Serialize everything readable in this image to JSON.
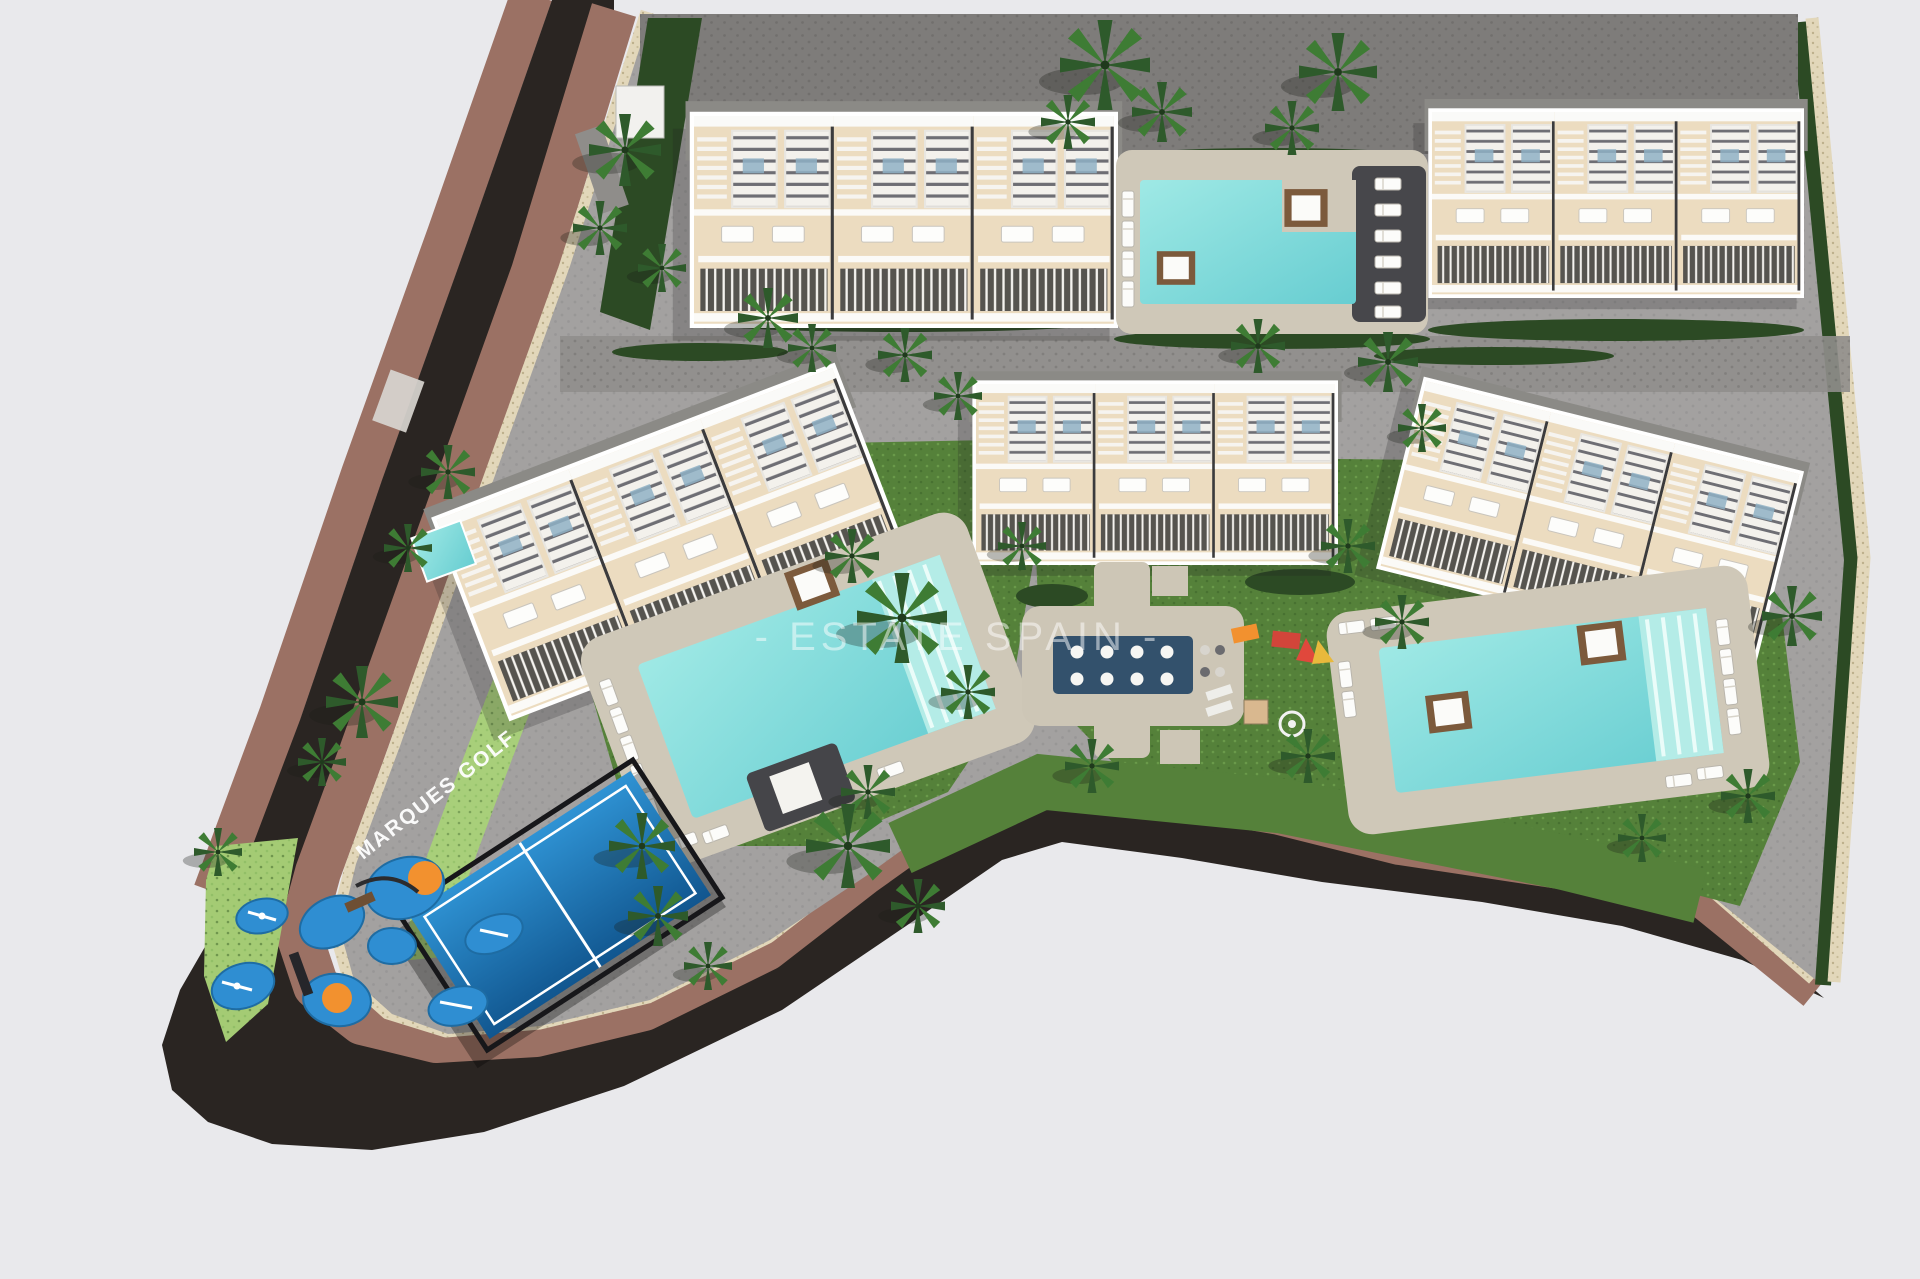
{
  "canvas": {
    "width": 1920,
    "height": 1279,
    "background": "#e9e9ec"
  },
  "watermark": {
    "text": "- ESTATE SPAIN -",
    "color": "#ffffff",
    "opacity": 0.5
  },
  "street_label": {
    "text": "MARQUES GOLF",
    "color": "#ffffff"
  },
  "palette": {
    "paving": "#a3a1a0",
    "parking": "#7e7c7a",
    "pathlight": "#cdc6b6",
    "deck": "#cfc8b8",
    "lawn": "#55813a",
    "lawnlight": "#a4cb74",
    "hedge": "#2c4a24",
    "hedgelight": "#a8cf7a",
    "water": "#84dedb",
    "navy": "#33516c",
    "padel": "#1d7fc2",
    "playblue": "#2f8ed2",
    "playorange": "#f2912f",
    "road": "#2a2522",
    "sidewalk": "#9b7164",
    "curb": "#e2d7ba",
    "building": "#ecdcc0",
    "roof": "#8b8a86",
    "buildingdark": "#3b3b3d",
    "daybed": "#7c5a3c",
    "white": "#ffffff"
  },
  "scene": {
    "description": "Aerial 3D site plan of a residential development with townhouse blocks, swimming pools, padel court and children playground",
    "buildings": [
      {
        "id": "north-west-block",
        "units": 3
      },
      {
        "id": "north-east-block",
        "units": 3
      },
      {
        "id": "west-block",
        "units": 3
      },
      {
        "id": "central-block",
        "units": 3
      },
      {
        "id": "east-block",
        "units": 3
      }
    ],
    "pools": [
      {
        "id": "north-pool"
      },
      {
        "id": "west-pool"
      },
      {
        "id": "east-pool"
      }
    ],
    "amenities": [
      "communal pools",
      "padel court",
      "children playground",
      "chill-out deck",
      "parking area",
      "palm garden"
    ],
    "palms": [
      [
        625,
        150,
        1.2
      ],
      [
        600,
        228,
        0.9
      ],
      [
        662,
        268,
        0.8
      ],
      [
        768,
        318,
        1.0
      ],
      [
        812,
        348,
        0.8
      ],
      [
        1105,
        65,
        1.5
      ],
      [
        1162,
        112,
        1.0
      ],
      [
        1068,
        122,
        0.9
      ],
      [
        1338,
        72,
        1.3
      ],
      [
        1292,
        128,
        0.9
      ],
      [
        905,
        355,
        0.9
      ],
      [
        958,
        396,
        0.8
      ],
      [
        1258,
        346,
        0.9
      ],
      [
        1388,
        362,
        1.0
      ],
      [
        1422,
        428,
        0.8
      ],
      [
        448,
        472,
        0.9
      ],
      [
        408,
        548,
        0.8
      ],
      [
        362,
        702,
        1.2
      ],
      [
        322,
        762,
        0.8
      ],
      [
        852,
        556,
        0.9
      ],
      [
        902,
        618,
        1.5
      ],
      [
        968,
        692,
        0.9
      ],
      [
        1022,
        546,
        0.8
      ],
      [
        1348,
        546,
        0.9
      ],
      [
        1402,
        622,
        0.9
      ],
      [
        1308,
        756,
        0.9
      ],
      [
        1092,
        766,
        0.9
      ],
      [
        868,
        792,
        0.9
      ],
      [
        642,
        846,
        1.1
      ],
      [
        848,
        846,
        1.4
      ],
      [
        918,
        906,
        0.9
      ],
      [
        658,
        916,
        1.0
      ],
      [
        708,
        966,
        0.8
      ],
      [
        1792,
        616,
        1.0
      ],
      [
        1748,
        796,
        0.9
      ],
      [
        1642,
        838,
        0.8
      ],
      [
        218,
        852,
        0.8
      ]
    ]
  }
}
